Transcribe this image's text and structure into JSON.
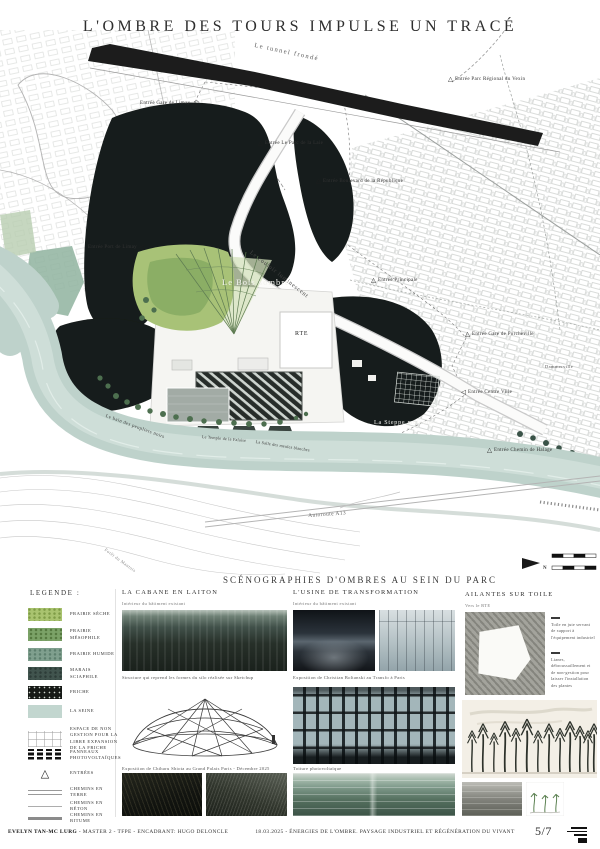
{
  "title": "L'OMBRE DES TOURS IMPULSE UN TRACÉ",
  "colors": {
    "seine": "#bed2cb",
    "friche": "#191d1a",
    "prairie_seche": "#a9c36f",
    "prairie_mesophile": "#7ba267",
    "prairie_humide": "#7f9f8e",
    "marais_sciaphile": "#41544e",
    "ink": "#2f2f2f"
  },
  "map": {
    "north_label": "N",
    "labels": [
      "Le tunnel frondé",
      "Entrée Parc Régional du Vexin",
      "Entrée Gare de Limay",
      "Entrée Le Parc de la Laie",
      "Entrée Boulevard de la République",
      "Entrée Port de Limay",
      "Le couloir luminescent",
      "Le Bois sombre",
      "Entrée Principale",
      "RTE",
      "Entrée Gare de Porcheville",
      "Dammerville",
      "Entrée Centre Ville",
      "La Steppe mutante",
      "Entrée Chemin de Halage",
      "Le bain des peupliers noirs",
      "Le Temple de la Falaise",
      "La Salle des meules blanches",
      "Autoroute A13",
      "Forêt du Mantois"
    ]
  },
  "legend": {
    "title": "LEGENDE :",
    "items": [
      {
        "label": "PRAIRIE SÈCHE"
      },
      {
        "label": "PRAIRIE MÉSOPHILE"
      },
      {
        "label": "PRAIRIE HUMIDE"
      },
      {
        "label": "MARAIS SCIAPHILE"
      },
      {
        "label": "FRICHE"
      },
      {
        "label": "LA SEINE"
      },
      {
        "label": "ESPACE DE NON GESTION POUR LA LIBRE EXPANSION DE LA FRICHE"
      },
      {
        "label": "PANNEAUX PHOTOVOLTAÏQUES"
      },
      {
        "label": "ENTRÉES"
      },
      {
        "label": "CHEMINS EN TERRE"
      },
      {
        "label": "CHEMINS EN BÉTON"
      },
      {
        "label": "CHEMINS EN BITUME"
      }
    ]
  },
  "scenes": {
    "title": "SCÉNOGRAPHIES D'OMBRES AU SEIN DU PARC",
    "columns": [
      {
        "heading": "LA CABANE EN LAITON",
        "subtitle": "Intérieur du bâtiment existant",
        "captions": [
          "Structure qui reprend les formes du silo réalisée sur Sketchup",
          "Exposition de Chiharu Shiota au Grand Palais Paris - Décembre 2025"
        ]
      },
      {
        "heading": "L'USINE DE TRANSFORMATION",
        "subtitle": "Intérieur du bâtiment existant",
        "captions": [
          "Exposition de Christian Boltanski au Transfo à Paris",
          "Toiture photovoltaïque"
        ]
      },
      {
        "heading": "AILANTES SUR TOILE",
        "subtitle": "Vers le RTE",
        "notes": [
          "Toile en jute servant de support à l'équipement industriel",
          "Lianes, débroussaillement et de non-gestion pour laisser l'installation des plantes"
        ]
      }
    ]
  },
  "footer": {
    "author": "EVELYN TAN-MC LURG",
    "meta": " - MASTER 2 - TFPE - ENCADRANT: HUGO DELONCLE",
    "center": "18.03.2025 - ÉNERGIES DE L'OMBRE. PAYSAGE INDUSTRIEL ET RÉGÉNÉRATION DU VIVANT",
    "page": "5/7"
  }
}
